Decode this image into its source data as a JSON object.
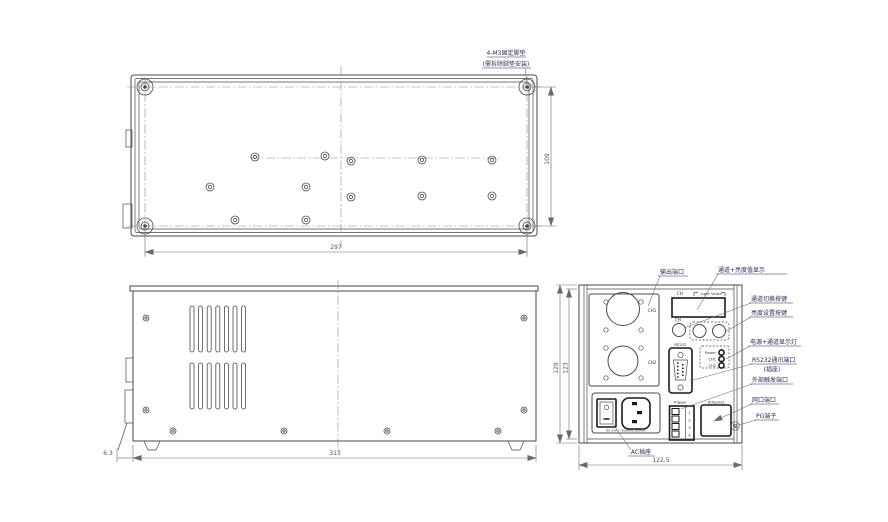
{
  "colors": {
    "outline": "#4a4a4a",
    "bold_connector": "#1a1a1a",
    "label": "#2d2d5c",
    "dimension": "#555555",
    "background": "#ffffff"
  },
  "top_view": {
    "foot_pad_note_line1": "4-M3固定脚垫",
    "foot_pad_note_line2": "(需拆除脚垫安装)",
    "dim_width": "297",
    "dim_depth": "109"
  },
  "side_view": {
    "dim_width": "313",
    "dim_foot_height": "6.3"
  },
  "rear_view": {
    "dim_height_outer": "129",
    "dim_height_inner": "123",
    "dim_width": "122.5",
    "display": {
      "ch_label": "CH",
      "value_label": "Light Value"
    },
    "buttons": {
      "ch": "CH"
    },
    "connectors": {
      "ch1": "CH1",
      "ch2": "CH2",
      "rs232": "RS232",
      "trigger": "Trigger",
      "ethernet": "Ethernet"
    },
    "leds": {
      "power": "Power",
      "ch1": "CH1",
      "ch2": "CH2"
    },
    "trigger_pins": [
      "1",
      "2",
      "3",
      "4"
    ],
    "ac_rating": "90-240V~50/60Hz 800mA"
  },
  "callouts": {
    "output_port": "输出端口",
    "display": "通道+亮度值显示",
    "channel_switch": "通道切换按键",
    "brightness_set": "亮度设置按键",
    "power_channel_leds": "电源+通道显示灯",
    "rs232_line1": "RS232通讯端口",
    "rs232_line2": "(插座)",
    "external_trigger": "外部触发端口",
    "network_port": "网口端口",
    "pg_terminal": "PG端子",
    "ac_socket": "AC插座"
  }
}
